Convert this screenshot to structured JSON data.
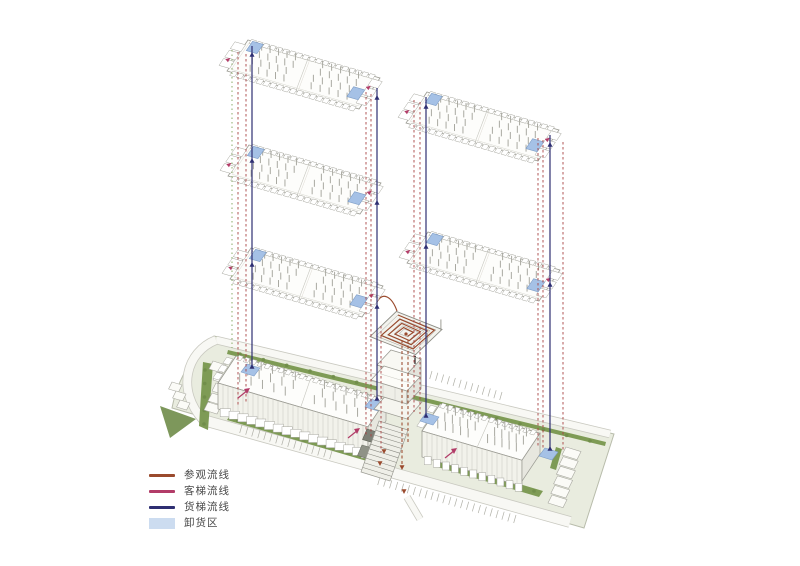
{
  "legend": {
    "items": [
      {
        "id": "visitor",
        "label": "参观流线",
        "color": "#9a4a2d",
        "swatch": "line"
      },
      {
        "id": "passenger",
        "label": "客梯流线",
        "color": "#b23c68",
        "swatch": "line"
      },
      {
        "id": "freight",
        "label": "货梯流线",
        "color": "#2e2f72",
        "swatch": "line"
      },
      {
        "id": "unloading",
        "label": "卸货区",
        "color": "#ccdcf0",
        "swatch": "area"
      }
    ]
  },
  "colors": {
    "background": "#ffffff",
    "site_fill": "#e9ecdf",
    "site_edge": "#b8bcab",
    "road_fill": "#f8f8f4",
    "road_edge": "#c9c9c0",
    "verge_green": "#7e9b55",
    "verge_dark": "#6f8c49",
    "building_line": "#9b9b93",
    "building_light": "#c6c6be",
    "deck_fill": "#fdfdfb",
    "wall_fill": "#f2f2eb",
    "wall_side": "#e7e7df",
    "tick": "#a9a9a1",
    "dock_blue": "#a5c1e6",
    "dock_blue_edge": "#7e9dc6",
    "shaft_red": "#a84343",
    "visitor": "#9a4a2d",
    "passenger": "#b23c68",
    "freight": "#2e2f72",
    "legend_unloading": "#ccdcf0",
    "pool_dark": "#7d8076",
    "pool_mid": "#8f9287",
    "site_dotted_green": "#8aab68",
    "figure_dark": "#3a3a38"
  },
  "diagram": {
    "description": "exploded-axonometric circulation diagram of a two-wing warehouse building",
    "floor_plates_left_tower": 3,
    "floor_plates_right_tower": 2,
    "ground_wings": 2,
    "features": [
      "spiral-ramp",
      "entrance-stairs",
      "loading-docks",
      "parking",
      "site-roads"
    ]
  }
}
